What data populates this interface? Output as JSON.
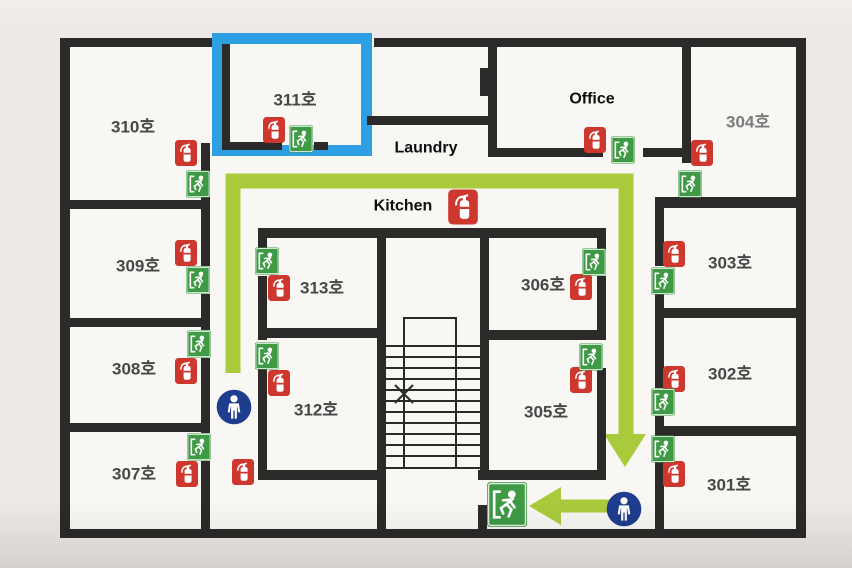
{
  "plan": {
    "rooms": {
      "r301": {
        "label": "301호"
      },
      "r302": {
        "label": "302호"
      },
      "r303": {
        "label": "303호"
      },
      "r304": {
        "label": "304호"
      },
      "r305": {
        "label": "305호"
      },
      "r306": {
        "label": "306호"
      },
      "r307": {
        "label": "307호"
      },
      "r308": {
        "label": "308호"
      },
      "r309": {
        "label": "309호"
      },
      "r310": {
        "label": "310호"
      },
      "r311": {
        "label": "311호"
      },
      "r312": {
        "label": "312호"
      },
      "r313": {
        "label": "313호"
      }
    },
    "areas": {
      "office": {
        "label": "Office"
      },
      "laundry": {
        "label": "Laundry"
      },
      "kitchen": {
        "label": "Kitchen"
      }
    },
    "highlight": {
      "room": "311호",
      "border_color": "#2e9fe3"
    },
    "route": {
      "color": "#a9cb3b"
    },
    "icons": {
      "fire_extinguisher": {
        "name": "fire-extinguisher-icon",
        "color": "#ce372e",
        "count": 16
      },
      "exit_sign": {
        "name": "exit-sign-icon",
        "color": "#3e9a45",
        "count": 15
      },
      "person": {
        "name": "person-icon",
        "color": "#1e3d8e",
        "count": 2
      }
    },
    "wall_color": "#2b2a28"
  }
}
